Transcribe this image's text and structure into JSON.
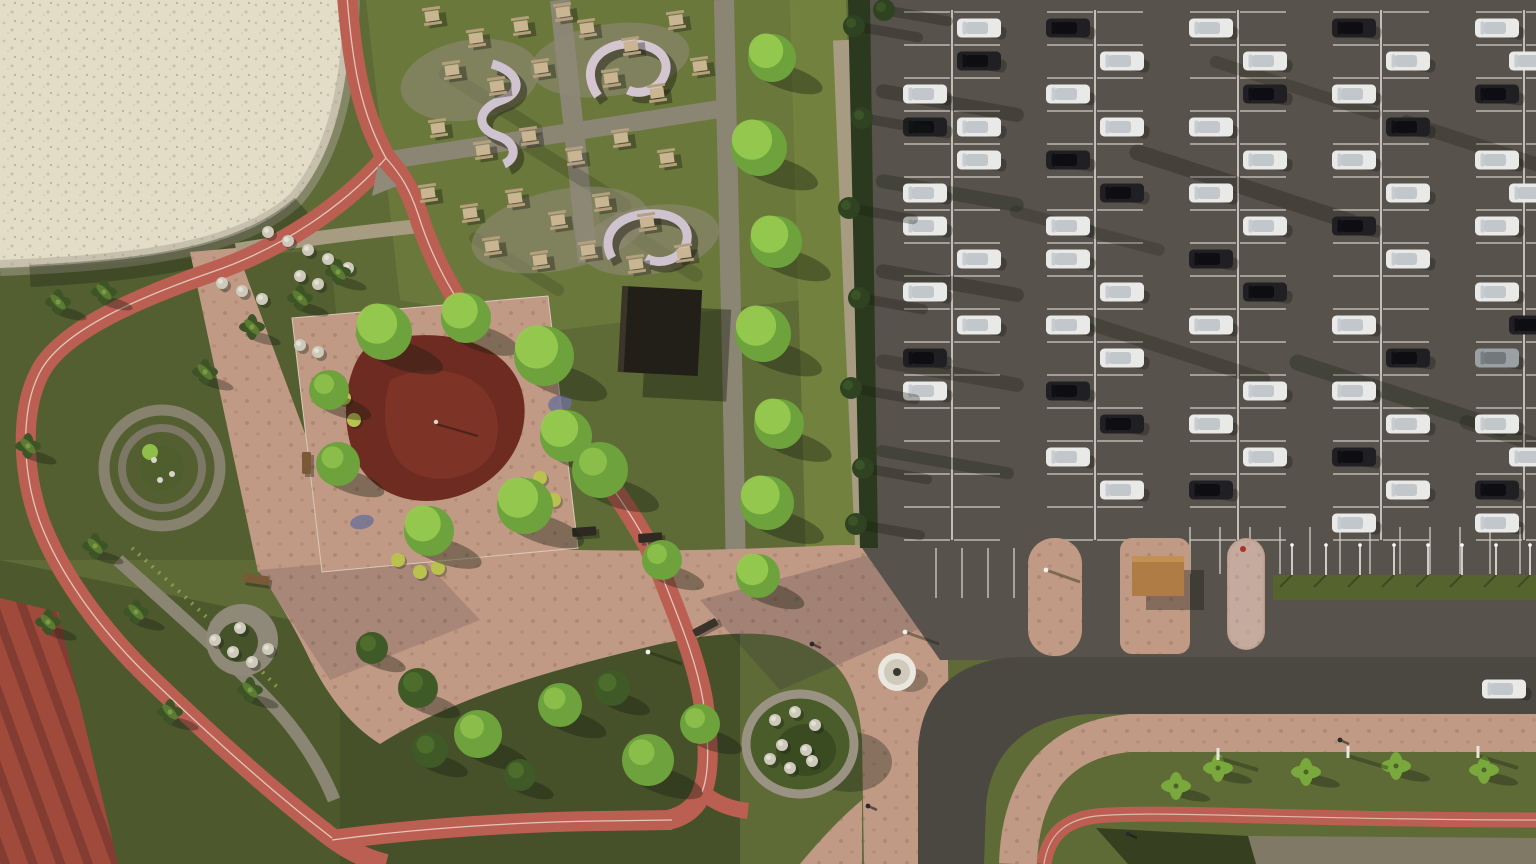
{
  "meta": {
    "scene_type": "aerial-3d-render",
    "subject": "park with running track, playground, picnic area and large parking lot",
    "width": 1536,
    "height": 864
  },
  "palette": {
    "grassBase": "#5e6b36",
    "grassLight": "#76843f",
    "grassPicnic": "#6d7a3c",
    "grassDark": "#3f4a28",
    "grassStrip": "#55642f",
    "sand": "#e3dcc6",
    "sandDot": "#cbc2a8",
    "sandShadow": "#a9a493",
    "track": "#bb5f53",
    "trackDark": "#9d4f47",
    "trackLine": "#ecdfd3",
    "paver": "#c19a85",
    "paverDot": "#9d765f",
    "gravel": "#a79c82",
    "cobble": "#8b8674",
    "asphalt": "#57524b",
    "asphaltRoad": "#4b4741",
    "stall": "#d6d2c9",
    "hedge": "#2b3a1e",
    "conifer": "#2f4222",
    "treeBright": "#97c94e",
    "treeMid": "#6da23c",
    "treeDark": "#3f5a26",
    "palm": "#3d5526",
    "palmLight": "#79a83c",
    "playRed": "#6e2b22",
    "playRed2": "#8a3a2a",
    "court": "#a04a3c",
    "courtStripe": "#7c382e",
    "shelter": "#b07c45",
    "fountain": "#eae7df",
    "flowerBed": "#6b6f96",
    "bushYellow": "#b9c24e",
    "bushWhite": "#cdc9bb",
    "shadow": "#171c10"
  },
  "scene": {
    "parking": {
      "dividerCols": [
        952,
        1095,
        1238,
        1381,
        1524
      ],
      "rowTop": 12,
      "rowStep": 33,
      "rows": 17,
      "halfLen": 48,
      "lineBottom": 540,
      "bottomRow": {
        "x1": 1190,
        "x2": 1536,
        "step": 30,
        "y1": 527,
        "y2": 574
      },
      "southStubs": {
        "xs": [
          936,
          962,
          988,
          1014
        ],
        "y1": 548,
        "y2": 598
      }
    },
    "cars": [
      [
        925,
        94,
        "w"
      ],
      [
        925,
        127,
        "k"
      ],
      [
        925,
        193,
        "w"
      ],
      [
        925,
        226,
        "w"
      ],
      [
        925,
        292,
        "w"
      ],
      [
        925,
        358,
        "k"
      ],
      [
        925,
        391,
        "w"
      ],
      [
        979,
        28,
        "w"
      ],
      [
        979,
        61,
        "k"
      ],
      [
        979,
        127,
        "w"
      ],
      [
        979,
        160,
        "w"
      ],
      [
        979,
        259,
        "w"
      ],
      [
        979,
        325,
        "w"
      ],
      [
        1068,
        28,
        "k"
      ],
      [
        1068,
        94,
        "w"
      ],
      [
        1068,
        160,
        "k"
      ],
      [
        1068,
        226,
        "w"
      ],
      [
        1068,
        259,
        "w"
      ],
      [
        1068,
        325,
        "w"
      ],
      [
        1068,
        391,
        "k"
      ],
      [
        1068,
        457,
        "w"
      ],
      [
        1122,
        61,
        "w"
      ],
      [
        1122,
        127,
        "w"
      ],
      [
        1122,
        193,
        "k"
      ],
      [
        1122,
        292,
        "w"
      ],
      [
        1122,
        358,
        "w"
      ],
      [
        1122,
        424,
        "k"
      ],
      [
        1122,
        490,
        "w"
      ],
      [
        1211,
        28,
        "w"
      ],
      [
        1211,
        127,
        "w"
      ],
      [
        1211,
        193,
        "w"
      ],
      [
        1211,
        259,
        "k"
      ],
      [
        1211,
        325,
        "w"
      ],
      [
        1211,
        424,
        "w"
      ],
      [
        1211,
        490,
        "k"
      ],
      [
        1265,
        61,
        "w"
      ],
      [
        1265,
        94,
        "k"
      ],
      [
        1265,
        160,
        "w"
      ],
      [
        1265,
        226,
        "w"
      ],
      [
        1265,
        292,
        "k"
      ],
      [
        1265,
        391,
        "w"
      ],
      [
        1265,
        457,
        "w"
      ],
      [
        1354,
        28,
        "k"
      ],
      [
        1354,
        94,
        "w"
      ],
      [
        1354,
        160,
        "w"
      ],
      [
        1354,
        226,
        "k"
      ],
      [
        1354,
        325,
        "w"
      ],
      [
        1354,
        391,
        "w"
      ],
      [
        1354,
        457,
        "k"
      ],
      [
        1354,
        523,
        "w"
      ],
      [
        1408,
        61,
        "w"
      ],
      [
        1408,
        127,
        "k"
      ],
      [
        1408,
        193,
        "w"
      ],
      [
        1408,
        259,
        "w"
      ],
      [
        1408,
        358,
        "k"
      ],
      [
        1408,
        424,
        "w"
      ],
      [
        1408,
        490,
        "w"
      ],
      [
        1497,
        28,
        "w"
      ],
      [
        1497,
        94,
        "k"
      ],
      [
        1497,
        160,
        "w"
      ],
      [
        1497,
        226,
        "w"
      ],
      [
        1497,
        292,
        "w"
      ],
      [
        1497,
        358,
        "g"
      ],
      [
        1497,
        424,
        "w"
      ],
      [
        1497,
        490,
        "k"
      ],
      [
        1497,
        523,
        "w"
      ],
      [
        1531,
        61,
        "w"
      ],
      [
        1531,
        193,
        "w"
      ],
      [
        1531,
        325,
        "k"
      ],
      [
        1531,
        457,
        "w"
      ]
    ],
    "roadCar": [
      1504,
      689,
      "w"
    ],
    "trees": {
      "bright": [
        [
          772,
          58,
          24
        ],
        [
          759,
          148,
          28
        ],
        [
          776,
          242,
          26
        ],
        [
          763,
          334,
          28
        ],
        [
          779,
          424,
          25
        ],
        [
          767,
          503,
          27
        ],
        [
          758,
          576,
          22
        ],
        [
          384,
          332,
          28
        ],
        [
          466,
          318,
          25
        ],
        [
          544,
          356,
          30
        ],
        [
          566,
          436,
          26
        ],
        [
          525,
          506,
          28
        ],
        [
          429,
          531,
          25
        ]
      ],
      "mid": [
        [
          338,
          464,
          22
        ],
        [
          329,
          390,
          20
        ],
        [
          600,
          470,
          28
        ],
        [
          662,
          560,
          20
        ],
        [
          478,
          734,
          24
        ],
        [
          560,
          705,
          22
        ],
        [
          648,
          760,
          26
        ],
        [
          700,
          724,
          20
        ]
      ],
      "dark": [
        [
          612,
          688,
          18
        ],
        [
          418,
          688,
          20
        ],
        [
          372,
          648,
          16
        ],
        [
          430,
          750,
          18
        ],
        [
          520,
          775,
          16
        ]
      ],
      "palms": [
        [
          58,
          302
        ],
        [
          104,
          292
        ],
        [
          252,
          327
        ],
        [
          300,
          298
        ],
        [
          338,
          272
        ],
        [
          205,
          372
        ],
        [
          95,
          546
        ],
        [
          48,
          622
        ],
        [
          136,
          612
        ],
        [
          28,
          446
        ],
        [
          170,
          712
        ],
        [
          250,
          690
        ]
      ],
      "lightPalms": [
        [
          1218,
          768
        ],
        [
          1306,
          772
        ],
        [
          1396,
          766
        ],
        [
          1484,
          770
        ],
        [
          1176,
          786
        ]
      ],
      "conifers": [
        [
          854,
          26
        ],
        [
          862,
          118
        ],
        [
          849,
          208
        ],
        [
          859,
          298
        ],
        [
          851,
          388
        ],
        [
          863,
          468
        ],
        [
          856,
          524
        ],
        [
          884,
          10
        ]
      ]
    },
    "picnicTables": [
      [
        432,
        16
      ],
      [
        476,
        38
      ],
      [
        521,
        26
      ],
      [
        563,
        12
      ],
      [
        452,
        70
      ],
      [
        497,
        86
      ],
      [
        541,
        68
      ],
      [
        587,
        28
      ],
      [
        631,
        46
      ],
      [
        676,
        20
      ],
      [
        611,
        78
      ],
      [
        657,
        93
      ],
      [
        700,
        66
      ],
      [
        438,
        128
      ],
      [
        483,
        150
      ],
      [
        529,
        136
      ],
      [
        575,
        156
      ],
      [
        621,
        138
      ],
      [
        667,
        158
      ],
      [
        428,
        193
      ],
      [
        470,
        213
      ],
      [
        515,
        198
      ],
      [
        558,
        220
      ],
      [
        602,
        202
      ],
      [
        647,
        222
      ],
      [
        492,
        246
      ],
      [
        540,
        260
      ],
      [
        588,
        250
      ],
      [
        636,
        264
      ],
      [
        684,
        253
      ]
    ],
    "whiteBushes": [
      [
        268,
        232
      ],
      [
        288,
        241
      ],
      [
        308,
        250
      ],
      [
        328,
        259
      ],
      [
        348,
        268
      ],
      [
        222,
        283
      ],
      [
        242,
        291
      ],
      [
        262,
        299
      ],
      [
        300,
        276
      ],
      [
        318,
        284
      ],
      [
        215,
        640
      ],
      [
        233,
        652
      ],
      [
        252,
        662
      ],
      [
        268,
        649
      ],
      [
        240,
        628
      ],
      [
        775,
        720
      ],
      [
        795,
        712
      ],
      [
        815,
        725
      ],
      [
        782,
        745
      ],
      [
        806,
        750
      ],
      [
        790,
        768
      ],
      [
        812,
        761
      ],
      [
        770,
        759
      ],
      [
        300,
        345
      ],
      [
        318,
        352
      ]
    ],
    "yellowBushes": [
      [
        344,
        398
      ],
      [
        354,
        420
      ],
      [
        540,
        478
      ],
      [
        554,
        500
      ],
      [
        398,
        560
      ],
      [
        420,
        572
      ],
      [
        438,
        568
      ]
    ],
    "flowerBeds": [
      [
        332,
        382,
        14,
        8
      ],
      [
        470,
        328,
        16,
        8
      ],
      [
        560,
        404,
        12,
        9
      ],
      [
        520,
        522,
        14,
        8
      ],
      [
        362,
        522,
        12,
        7
      ],
      [
        545,
        360,
        10,
        7
      ]
    ],
    "shadowStreaks": [
      [
        876,
        90,
        150,
        14,
        10,
        0.3
      ],
      [
        876,
        180,
        150,
        14,
        10,
        0.28
      ],
      [
        876,
        270,
        150,
        14,
        10,
        0.3
      ],
      [
        876,
        360,
        150,
        14,
        10,
        0.26
      ],
      [
        876,
        450,
        140,
        12,
        10,
        0.28
      ],
      [
        1130,
        150,
        240,
        16,
        18,
        0.3
      ],
      [
        1080,
        320,
        200,
        14,
        18,
        0.26
      ],
      [
        1290,
        360,
        230,
        16,
        18,
        0.28
      ],
      [
        1400,
        120,
        200,
        14,
        18,
        0.26
      ],
      [
        1210,
        60,
        180,
        12,
        18,
        0.24
      ],
      [
        1460,
        420,
        180,
        14,
        18,
        0.26
      ],
      [
        1010,
        210,
        160,
        12,
        15,
        0.22
      ],
      [
        440,
        70,
        120,
        14,
        32,
        0.18
      ],
      [
        520,
        140,
        130,
        14,
        32,
        0.18
      ],
      [
        600,
        215,
        120,
        14,
        32,
        0.16
      ],
      [
        470,
        235,
        110,
        12,
        32,
        0.16
      ]
    ],
    "stripPoles": {
      "xs": [
        1292,
        1326,
        1360,
        1394,
        1428,
        1462,
        1496,
        1530
      ],
      "yTop": 545,
      "yBase": 575
    },
    "grassPosts": [
      [
        1218,
        748
      ],
      [
        1348,
        746
      ],
      [
        1478,
        746
      ]
    ],
    "plazaPoles": [
      [
        648,
        652
      ],
      [
        905,
        632
      ],
      [
        1046,
        570
      ]
    ],
    "benches": [
      [
        244,
        573,
        26,
        9,
        8,
        "#7a5a36"
      ],
      [
        302,
        452,
        9,
        22,
        0,
        "#7a5a36"
      ],
      [
        572,
        528,
        24,
        9,
        -4,
        "#2e2a22"
      ],
      [
        638,
        534,
        24,
        9,
        -4,
        "#2e2a22"
      ],
      [
        692,
        630,
        26,
        8,
        -28,
        "#3a332a"
      ]
    ],
    "people": [
      [
        1128,
        834
      ],
      [
        868,
        806
      ],
      [
        812,
        644
      ],
      [
        1340,
        740
      ]
    ],
    "gravelPads": [
      [
        470,
        80,
        70,
        40,
        -10
      ],
      [
        610,
        60,
        80,
        36,
        -8
      ],
      [
        560,
        230,
        90,
        40,
        -12
      ],
      [
        650,
        240,
        70,
        34,
        -10
      ]
    ]
  }
}
